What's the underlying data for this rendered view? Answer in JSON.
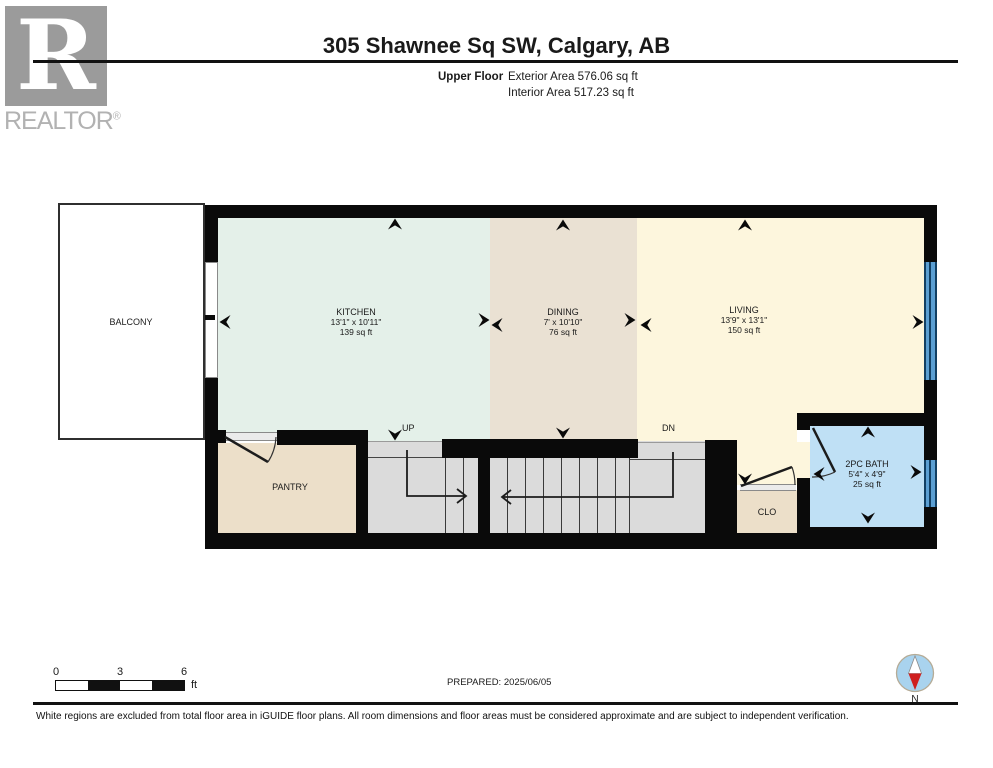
{
  "header": {
    "logo_letter": "R",
    "logo_brand": "REALTOR",
    "logo_reg": "®",
    "title": "305 Shawnee Sq SW, Calgary, AB",
    "floor_label": "Upper Floor",
    "exterior_area": "Exterior Area 576.06 sq ft",
    "interior_area": "Interior Area 517.23 sq ft"
  },
  "rooms": {
    "balcony": {
      "name": "BALCONY"
    },
    "kitchen": {
      "name": "KITCHEN",
      "dims": "13'1\" x 10'11\"",
      "area": "139 sq ft"
    },
    "dining": {
      "name": "DINING",
      "dims": "7' x 10'10\"",
      "area": "76 sq ft"
    },
    "living": {
      "name": "LIVING",
      "dims": "13'9\" x 13'1\"",
      "area": "150 sq ft"
    },
    "pantry": {
      "name": "PANTRY"
    },
    "closet": {
      "name": "CLO"
    },
    "bath": {
      "name": "2PC BATH",
      "dims": "5'4\" x 4'9\"",
      "area": "25 sq ft"
    }
  },
  "stairs": {
    "up_label": "UP",
    "dn_label": "DN"
  },
  "scale_bar": {
    "tick0": "0",
    "tick3": "3",
    "tick6": "6",
    "unit": "ft"
  },
  "footer": {
    "prepared": "PREPARED: 2025/06/05",
    "compass_label": "N",
    "disclaimer": "White regions are excluded from total floor area in iGUIDE floor plans. All room dimensions and floor areas must be considered approximate and are subject to independent verification."
  },
  "colors": {
    "wall": "#0a0a0a",
    "kitchen": "#e4f0e9",
    "dining": "#eae1d3",
    "living": "#fdf6dd",
    "pantry_closet": "#ecdfc9",
    "bath": "#bfe0f5",
    "stairs": "#dbdbdb",
    "window_blue": "#5b9fd3",
    "compass_blue": "#a9d3ee",
    "compass_red": "#cf1f1f",
    "logo_gray": "#9b9b9b"
  }
}
